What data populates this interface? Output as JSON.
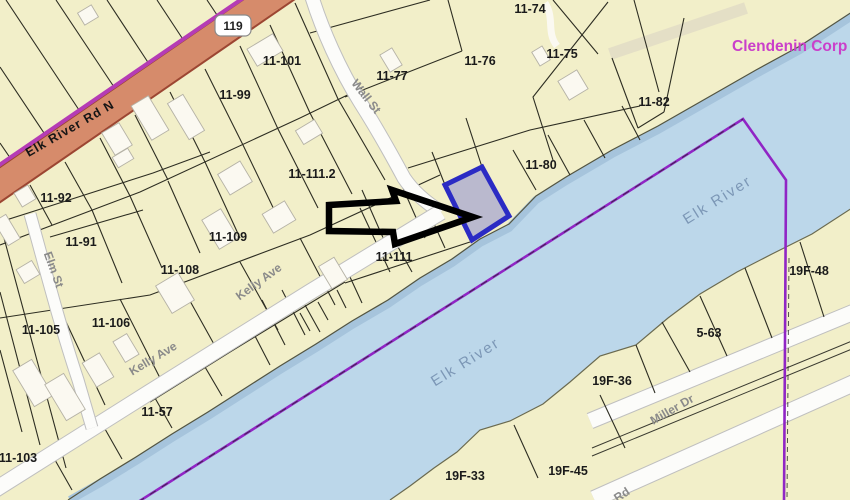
{
  "map": {
    "parcels": [
      "11-74",
      "11-75",
      "11-76",
      "11-77",
      "11-80",
      "11-82",
      "11-101",
      "11-99",
      "11-111.2",
      "11-92",
      "11-91",
      "11-109",
      "11-108",
      "11-106",
      "11-105",
      "11-111",
      "11-57",
      "11-103",
      "19F-48",
      "5-63",
      "19F-36",
      "19F-33",
      "19F-45"
    ],
    "roads": {
      "elk_river_rd": "Elk River Rd N",
      "wall_st": "Wall St",
      "kelly_ave": "Kelly Ave",
      "elm_st": "Elm St",
      "miller_dr": "Miller Dr",
      "rd_fragment": "Rd"
    },
    "route_shield": "119",
    "water": {
      "river_name": "Elk River"
    },
    "owner_label": "Clendenin Corp",
    "colors": {
      "land": "#F2EFC9",
      "water": "#BCD7EA",
      "highlight_fill": "#8C8CD2",
      "highlight_border": "#2B2BC4",
      "boundary_line": "#9025C5",
      "major_road": "#D68B6B",
      "owner_text": "#CA3FCA"
    }
  }
}
